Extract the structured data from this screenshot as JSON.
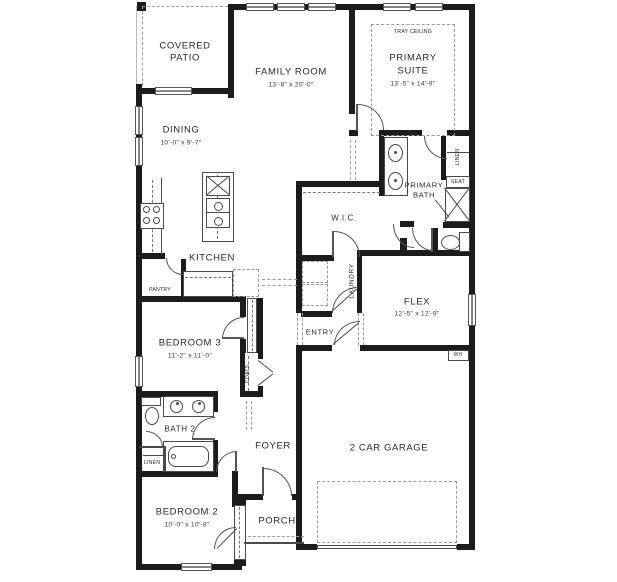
{
  "colors": {
    "wall": "#1c1c1c",
    "line": "#4a4a4a",
    "dash": "#9a9a9a",
    "text": "#2a2a2a",
    "paper": "#ffffff"
  },
  "rooms": {
    "covered_patio": {
      "line1": "COVERED",
      "line2": "PATIO"
    },
    "family_room": {
      "label": "FAMILY ROOM",
      "dims": "13'-8\" x 20'-0\""
    },
    "tray_ceiling": {
      "label": "TRAY CEILING"
    },
    "primary_suite": {
      "line1": "PRIMARY",
      "line2": "SUITE",
      "dims": "13'-5\" x 14'-9\""
    },
    "dining": {
      "label": "DINING",
      "dims": "10'-0\" x 9'-7\""
    },
    "kitchen": {
      "label": "KITCHEN"
    },
    "pantry": {
      "label": "PANTRY"
    },
    "wic": {
      "label": "W.I.C."
    },
    "primary_bath": {
      "line1": "PRIMARY",
      "line2": "BATH"
    },
    "linen_primary": {
      "label": "LINEN"
    },
    "seat": {
      "label": "SEAT"
    },
    "laundry": {
      "label": "LAUNDRY"
    },
    "flex": {
      "label": "FLEX",
      "dims": "12'-5\" x 12'-9\""
    },
    "entry": {
      "label": "ENTRY"
    },
    "bedroom3": {
      "label": "BEDROOM 3",
      "dims": "11'-2\" x 11'-0\""
    },
    "coats": {
      "label": "COATS"
    },
    "water_heater": {
      "label": "WH"
    },
    "bath2": {
      "label": "BATH 2"
    },
    "linen_bath2": {
      "label": "LINEN"
    },
    "foyer": {
      "label": "FOYER"
    },
    "bedroom2": {
      "label": "BEDROOM 2",
      "dims": "10'-0\" x 10'-8\""
    },
    "porch": {
      "label": "PORCH"
    },
    "garage": {
      "label": "2 CAR GARAGE"
    }
  }
}
